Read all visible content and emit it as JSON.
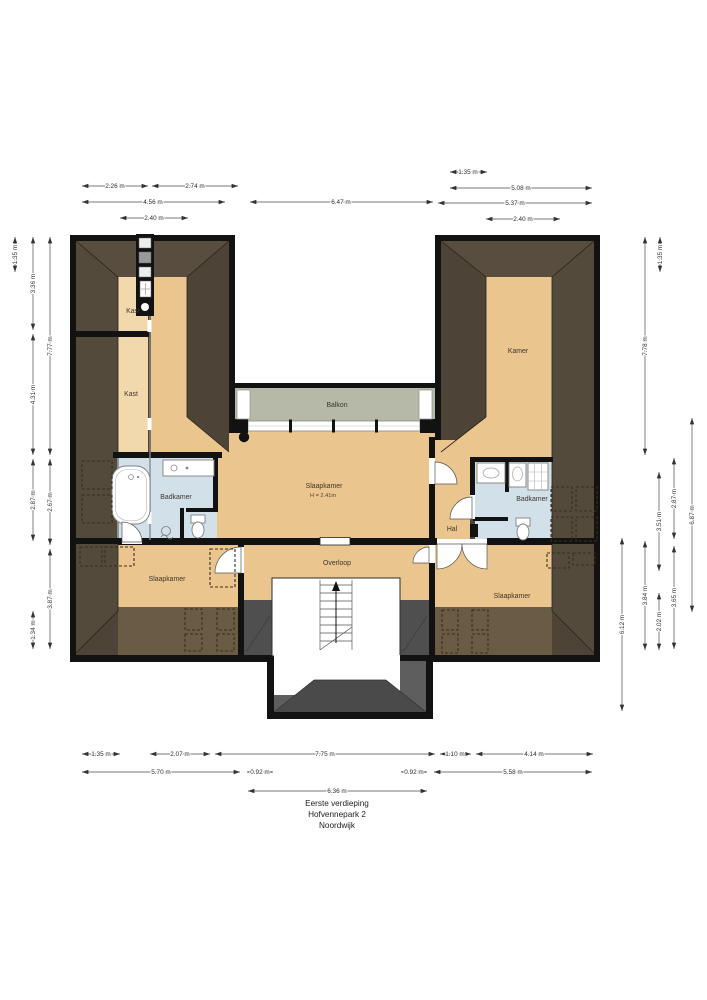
{
  "title": {
    "floor": "Eerste verdieping",
    "street": "Hofvennepark 2",
    "city": "Noordwijk"
  },
  "rooms": {
    "kast_upper": "Kast",
    "kast_lower": "Kast",
    "badkamer_left": "Badkamer",
    "slaapkamer_center": "Slaapkamer",
    "slaapkamer_center_note": "H = 2.41m",
    "balkon": "Balkon",
    "kamer": "Kamer",
    "hal": "Hal",
    "badkamer_right": "Badkamer",
    "overloop": "Overloop",
    "slaapkamer_left": "Slaapkamer",
    "slaapkamer_right": "Slaapkamer"
  },
  "dimensions": {
    "top": [
      "2.26 m",
      "2.74 m",
      "4.56 m",
      "2.40 m",
      "6.47 m",
      "1.35 m",
      "5.08 m",
      "5.37 m",
      "2.40 m"
    ],
    "left": [
      "1.35 m",
      "3.36 m",
      "4.31 m",
      "2.87 m",
      "1.34 m",
      "7.77 m",
      "2.67 m",
      "3.87 m"
    ],
    "right": [
      "7.78 m",
      "1.35 m",
      "3.51 m",
      "2.02 m",
      "2.87 m",
      "3.65 m",
      "3.84 m",
      "6.87 m",
      "6.12 m"
    ],
    "bottom": [
      "1.35 m",
      "2.07 m",
      "7.75 m",
      "1.10 m",
      "4.14 m",
      "5.70 m",
      "0.92 m",
      "0.92 m",
      "5.58 m",
      "6.36 m"
    ]
  },
  "palette": {
    "wall": "#121212",
    "roof_dark": "#4d4437",
    "roof_light": "#584d3f",
    "roof_side": "#544a3c",
    "eaves_brown": "#6a5b44",
    "floor": "#eac58e",
    "floor_light": "#f2d9ad",
    "balcony": "#b6b9a8",
    "bathroom": "#d2e0ea",
    "dormer_grey": "#5e5e5e",
    "dormer_dark": "#4a4a4a"
  }
}
